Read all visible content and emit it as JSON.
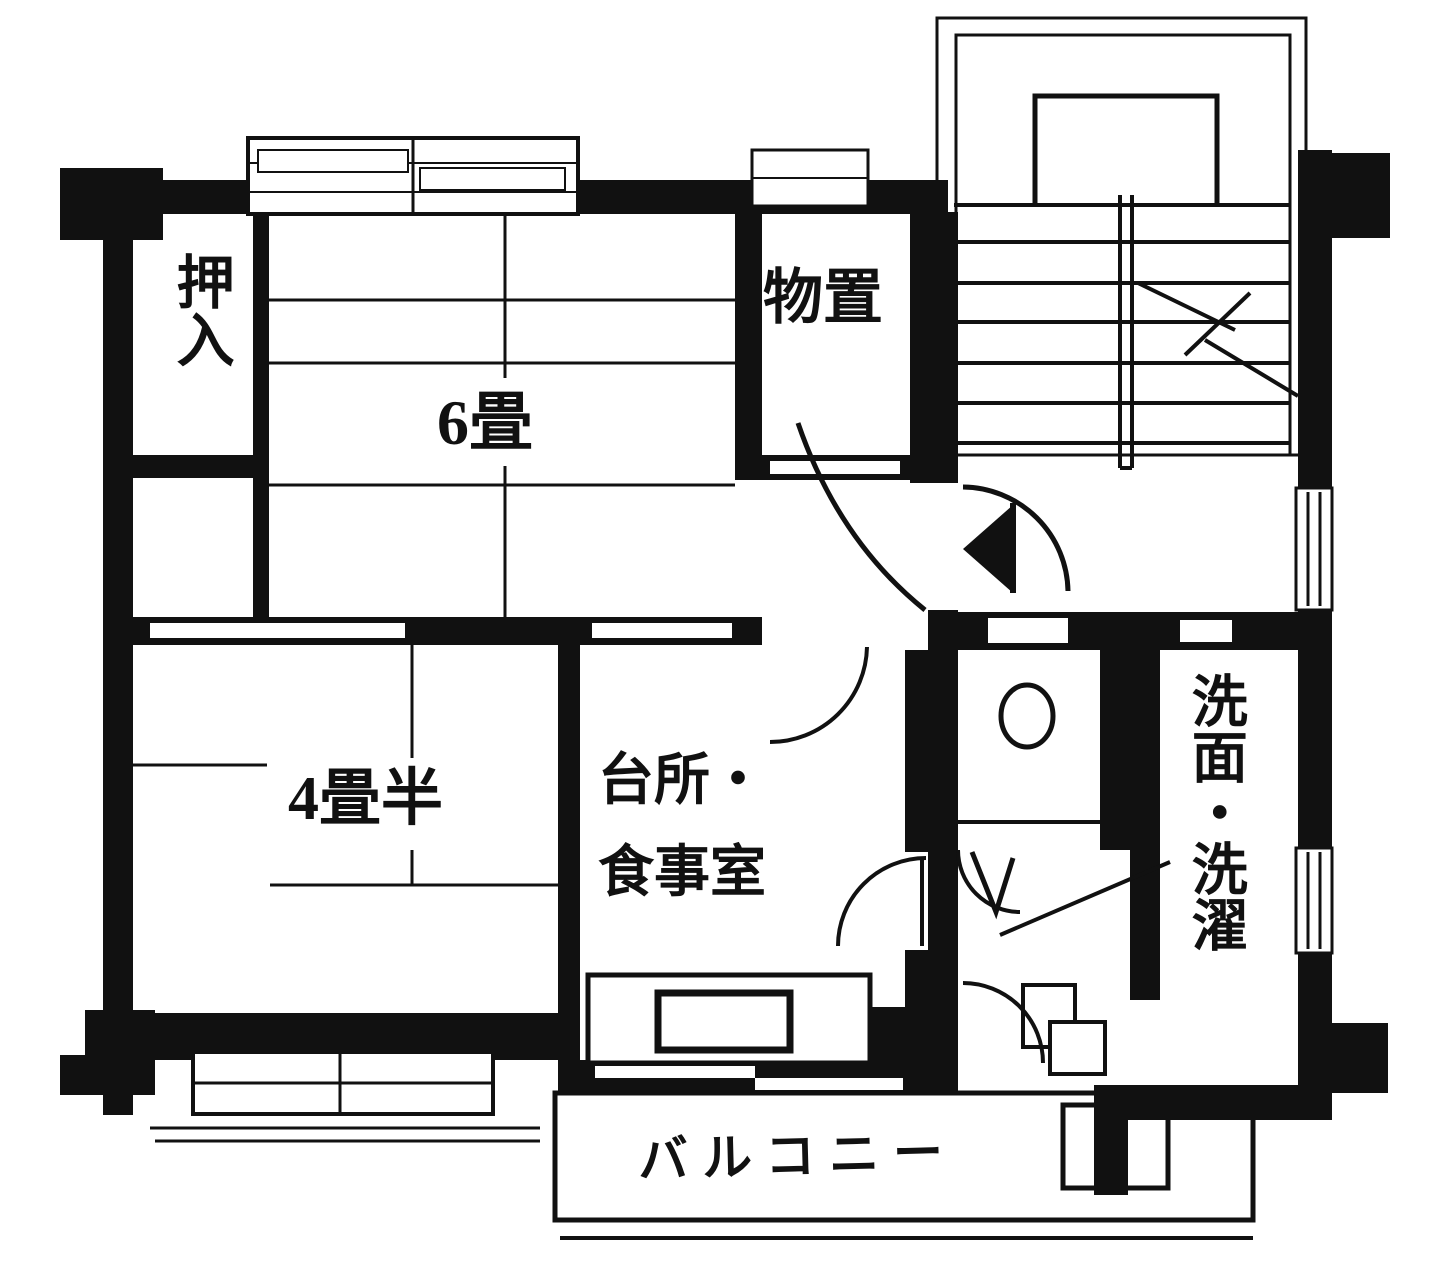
{
  "plan": {
    "type": "floor-plan",
    "language": "ja"
  },
  "rooms": {
    "oshiire": {
      "label": "押入"
    },
    "six_mat": {
      "label": "6畳"
    },
    "storage": {
      "label": "物置"
    },
    "four_half": {
      "label": "4畳半"
    },
    "kitchen": {
      "lines": [
        "台所・",
        "食事室"
      ]
    },
    "washroom": {
      "label": "洗面・洗濯"
    },
    "balcony": {
      "label": "バルコニー"
    }
  },
  "icons": {
    "toilet": "toilet-bowl-icon",
    "kitchen_sink": "kitchen-sink-icon",
    "washbasin": "washbasin-icon",
    "stairs": "staircase-icon",
    "stair_break": "stair-break-mark-icon",
    "entry_door": "entry-door-icon",
    "door_swing": "door-swing-arc-icon",
    "sliding_window": "sliding-window-icon",
    "sliding_door": "sliding-door-icon",
    "balcony_partition": "balcony-partition-icon"
  },
  "colors": {
    "ink": "#111111",
    "paper": "#ffffff"
  }
}
